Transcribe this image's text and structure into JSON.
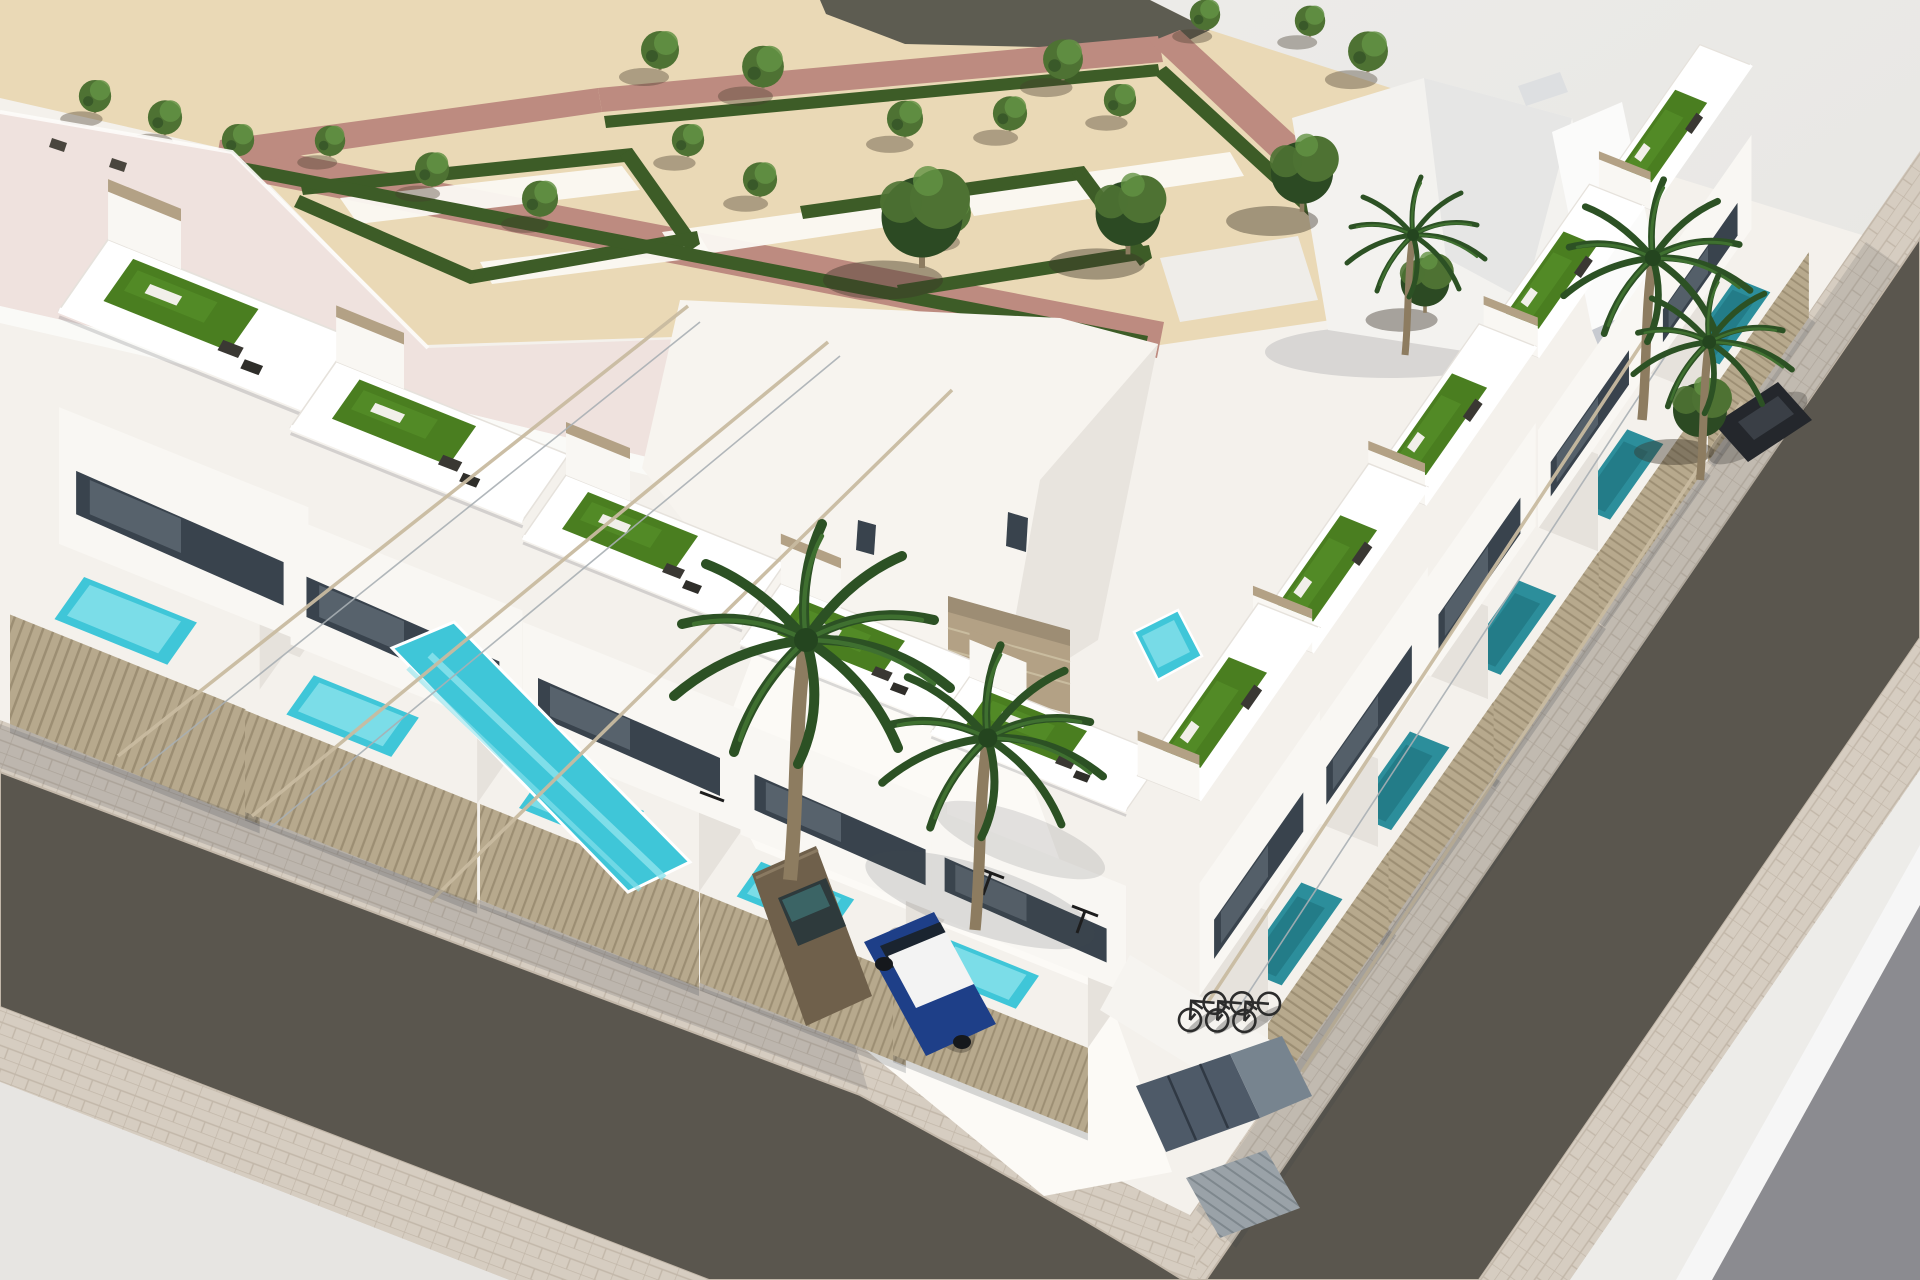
{
  "meta": {
    "content_type": "3d-architectural-render",
    "view": "aerial-corner-perspective",
    "subject": "new-build white townhouse complex with roof terraces, private pools, corner streets and a landscaped park"
  },
  "palette": {
    "base_bg": "#ebeae8",
    "ground_corner": "#e7e5e2",
    "ground_corner2": "#edecE9",
    "corner_wedge": "#8b8b90",
    "sand": "#ead9b6",
    "sand_dark_strip": "#4e4e46",
    "park_path": "#bd8b80",
    "walkway_white": "#fbf9f3",
    "hedge": "#3d5c27",
    "tree_green": "#4e7233",
    "tree_hi": "#639244",
    "tree_dark": "#2c4a23",
    "roof_pink": "#efe2de",
    "roof_edge": "#fdfcfa",
    "block_ground": "#f4f1ec",
    "wall_white": "#f9f7f3",
    "wall_lit": "#ffffff",
    "wall_shade": "#e6e2dc",
    "wall_dark": "#cdc9c2",
    "glass_dark": "#39434d",
    "glass_light": "#76828c",
    "turf": "#4a7e20",
    "turf_hi": "#58922c",
    "pool_main": "#3fc6d8",
    "pool_light": "#90e4ee",
    "pool_teal": "#2c8e9b",
    "fence": "#b7a98d",
    "fence_line": "#9c8e73",
    "accent_beige": "#b3a185",
    "asphalt": "#5a564e",
    "paver": "#d6cdc1",
    "paver_line": "#c2b7a9",
    "drive_white": "#fcfaf6",
    "pergola_wood": "#c8bba0",
    "pergola_steel": "#a8afb4",
    "furniture_dark": "#3a3833",
    "lounger_white": "#f1efe9",
    "car_blue_body": "#1e3f88",
    "car_roof_white": "#f3f3f3",
    "car_bronze_body": "#6f604b",
    "car_dark_body": "#24272c",
    "metal_door": "#4e5a68",
    "metal_door_light": "#77848f",
    "corr_gate": "#9aa2a8",
    "palm_dark": "#2c5124",
    "palm_light": "#3f7030",
    "trunk": "#8d7c60",
    "shadow_soft": "rgba(50,54,66,0.15)"
  },
  "scene": {
    "environment": {
      "park": {
        "tree_count": 19,
        "hedge_layout": "angular-parterre",
        "paths": "red-clay",
        "ground": "sand-gravel"
      },
      "adjacent_building": "large-flat-pink-roof",
      "streets": {
        "count": 2,
        "surface": "asphalt",
        "sidewalks": "beige-pavers",
        "corner": "rounded"
      }
    },
    "complex": {
      "rows": [
        {
          "side": "left",
          "units": 5
        },
        {
          "side": "right",
          "units": 5
        }
      ],
      "features": [
        "roof-terraces-with-artificial-turf",
        "sun-loungers",
        "rattan-lounge-sets",
        "pergola-beams",
        "glass-railings",
        "private-pools",
        "slatted-fences",
        "carport",
        "bike-shelter",
        "utility-doors"
      ]
    },
    "pools": {
      "turquoise": 4,
      "teal": 2,
      "long_lap_pool": 1
    },
    "vehicles": [
      {
        "type": "hatchback",
        "body_color_key": "car_blue_body",
        "roof": "white"
      },
      {
        "type": "suv",
        "body_color_key": "car_bronze_body"
      },
      {
        "type": "car",
        "body_color_key": "car_dark_body"
      }
    ],
    "bicycles": 3,
    "palm_trees": 5
  }
}
